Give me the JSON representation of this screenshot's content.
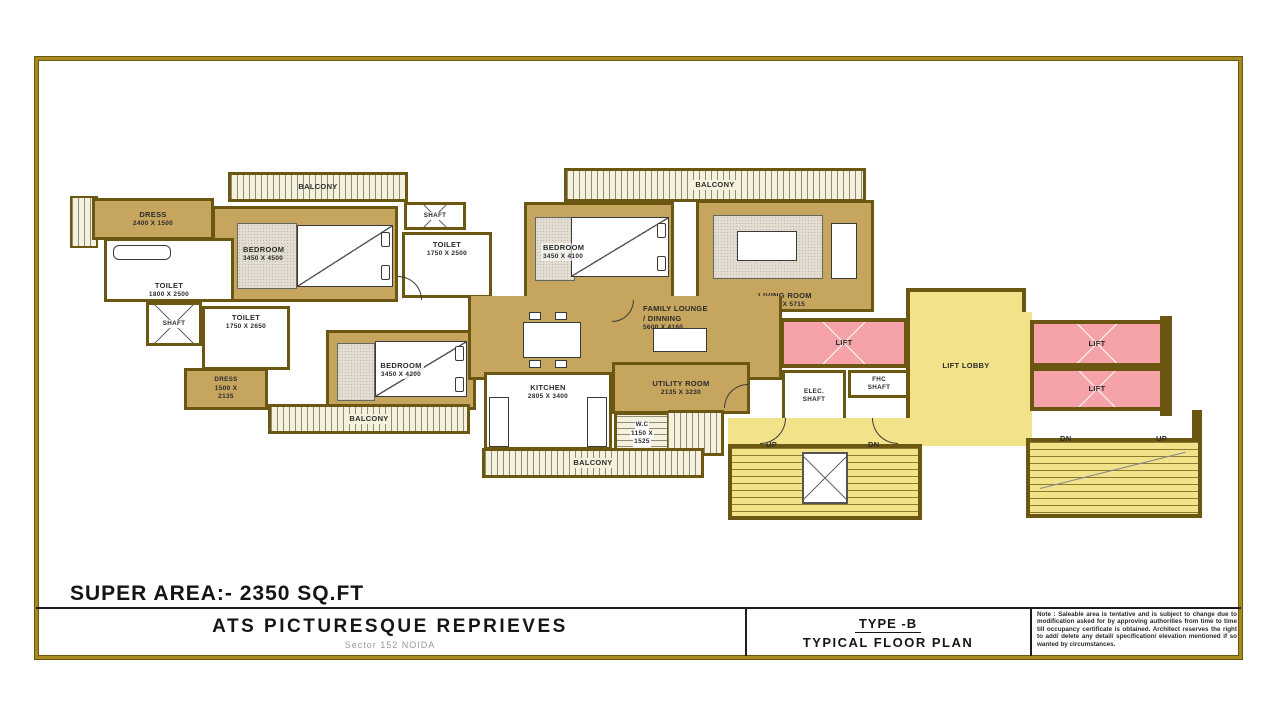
{
  "title_block": {
    "super_area": "SUPER AREA:- 2350 SQ.FT",
    "project_name": "ATS PICTURESQUE REPRIEVES",
    "project_location": "Sector 152 NOIDA",
    "plan_type": "TYPE -B",
    "plan_name": "TYPICAL FLOOR PLAN",
    "note": "Note : Saleable area is tentative and is subject to change due to modification asked for by approving authorities from time to time till occupancy certificate is obtained. Architect reserves the right to add/ delete any detail/ specification/ elevation mentioned if so wanted by circumstances."
  },
  "rooms": {
    "balcony1": {
      "name": "BALCONY"
    },
    "balcony2": {
      "name": "BALCONY"
    },
    "balcony3": {
      "name": "BALCONY"
    },
    "balcony4": {
      "name": "BALCONY"
    },
    "dress1": {
      "name": "DRESS",
      "dims": "2400 X 1500"
    },
    "dress2": {
      "name": "DRESS",
      "dims1": "1500 X",
      "dims2": "2135"
    },
    "toilet1": {
      "name": "TOILET",
      "dims": "1800 X 2500"
    },
    "toilet2": {
      "name": "TOILET",
      "dims": "1750 X 2500"
    },
    "toilet3": {
      "name": "TOILET",
      "dims": "1750 X 2650"
    },
    "shaft1": {
      "name": "SHAFT"
    },
    "shaft2": {
      "name": "SHAFT"
    },
    "bedroom1": {
      "name": "BEDROOM",
      "dims": "3450 X 4500"
    },
    "bedroom2": {
      "name": "BEDROOM",
      "dims": "3450 X 4100"
    },
    "bedroom3": {
      "name": "BEDROOM",
      "dims": "3450 X 4200"
    },
    "living": {
      "name": "LIVING ROOM",
      "dims": "3600 X 5715"
    },
    "lounge": {
      "line1": "FAMILY LOUNGE",
      "line2": "/ DINNING",
      "dims": "5600 X 4160"
    },
    "kitchen": {
      "name": "KITCHEN",
      "dims": "2805 X 3400"
    },
    "utility": {
      "name": "UTILITY ROOM",
      "dims": "2135 X 3230"
    },
    "wc": {
      "name": "W.C",
      "dims1": "1150 X",
      "dims2": "1525"
    },
    "lift1": {
      "name": "LIFT"
    },
    "lift2": {
      "name": "LIFT"
    },
    "lift3": {
      "name": "LIFT"
    },
    "fhc": {
      "line1": "FHC",
      "line2": "SHAFT"
    },
    "elec": {
      "line1": "ELEC.",
      "line2": "SHAFT"
    },
    "lobby": {
      "name": "LIFT LOBBY"
    },
    "stair1": {
      "up": "UP",
      "dn": "DN"
    },
    "stair2": {
      "dn": "DN",
      "up": "UP"
    }
  },
  "colors": {
    "wall": "#6B5712",
    "floor": "#C6A55E",
    "lobby_yellow": "#F2E28A",
    "lift_pink": "#F5A3A8",
    "frame_gold": "#A8891F"
  }
}
